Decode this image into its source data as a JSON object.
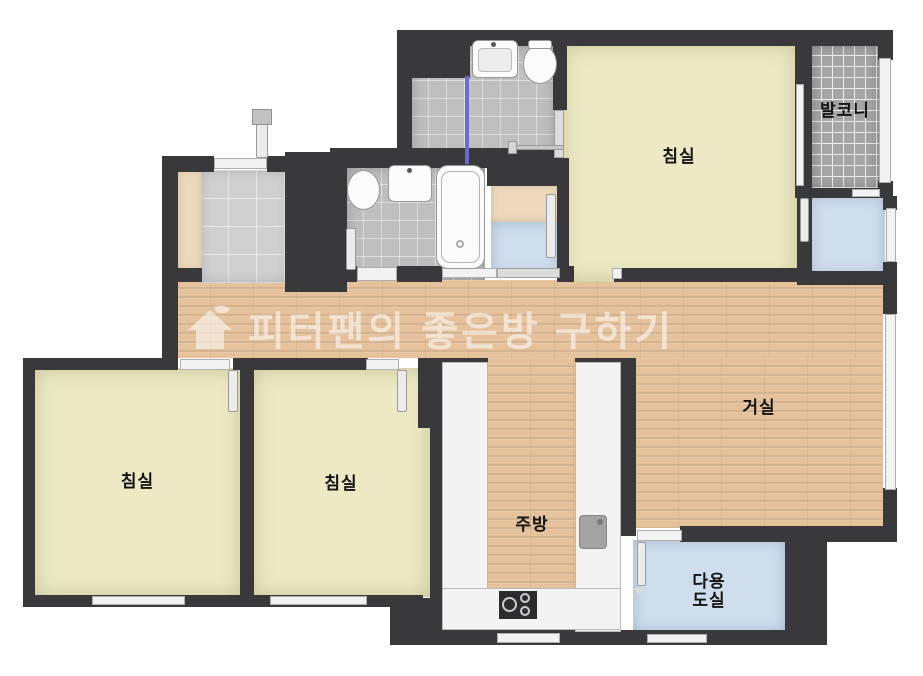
{
  "watermark": {
    "icon": "house-logo-icon",
    "text": "피터팬의 좋은방 구하기"
  },
  "rooms": [
    {
      "id": "bedroom-top",
      "label": "침실"
    },
    {
      "id": "bedroom-left",
      "label": "침실"
    },
    {
      "id": "bedroom-middle",
      "label": "침실"
    },
    {
      "id": "living-room",
      "label": "거실"
    },
    {
      "id": "kitchen",
      "label": "주방"
    },
    {
      "id": "balcony",
      "label": "발코니"
    },
    {
      "id": "utility-room",
      "label": "다용도실",
      "line1": "다용",
      "line2": "도실"
    }
  ],
  "colors": {
    "wall": "#39393b",
    "bedroom_floor": "#ece9c4",
    "wood_floor": "#e5c29c",
    "bathroom_tile": "#bfbfbf",
    "balcony_tile": "#a5a5a5",
    "utility_floor": "#cfdeed",
    "entrance_tile": "#d0d0d0",
    "cabinet_beige": "#ecd9bd",
    "fixture_white": "#f2f2f2",
    "shower_screen_blue": "#6b6bd0",
    "label_text": "#131313",
    "watermark_text": "rgba(255,255,255,0.55)"
  }
}
